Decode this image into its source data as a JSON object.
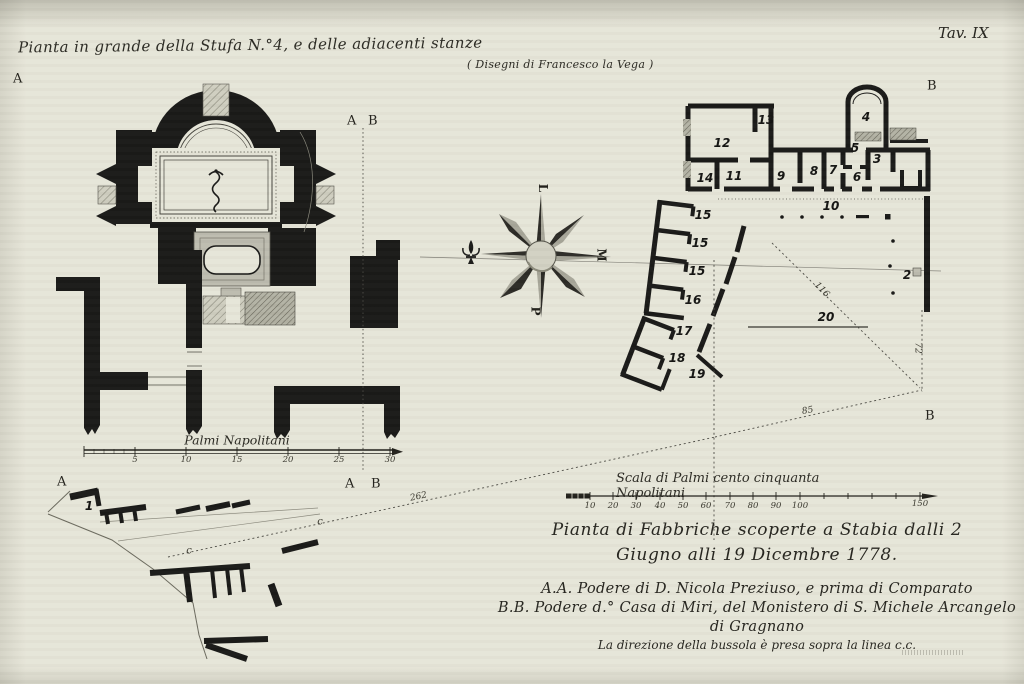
{
  "plate": {
    "number": "Tav. IX"
  },
  "titles": {
    "left_plan": "Pianta in grande della Stufa N.°4, e delle adiacenti stanze",
    "credit": "( Disegni di Francesco la Vega )"
  },
  "captions": {
    "line1": "Pianta di Fabbriche scoperte a Stabia dalli 2",
    "line2": "Giugno alli 19 Dicembre 1778.",
    "line3": "A.A. Podere di D. Nicola Preziuso, e prima di Comparato",
    "line4": "B.B. Podere d.° Casa di Miri, del Monistero di S. Michele Arcangelo",
    "line5": "di Gragnano",
    "line6": "La direzione della bussola è presa sopra la linea c.c."
  },
  "scales": {
    "left": {
      "label": "Palmi Napolitani",
      "ticks": [
        "5",
        "10",
        "15",
        "20",
        "25",
        "30"
      ]
    },
    "right": {
      "label": "Scala di Palmi cento cinquanta Napolitani",
      "ticks": [
        "10",
        "20",
        "30",
        "40",
        "50",
        "60",
        "70",
        "80",
        "90",
        "100",
        "150"
      ]
    }
  },
  "compass": {
    "east": "L",
    "south": "M",
    "west": "P"
  },
  "section_labels": {
    "a_top": "A",
    "ab_top_a": "A",
    "ab_top_b": "B",
    "ab_bottom_a": "A",
    "ab_bottom_b": "B",
    "b_top_right": "B",
    "b_bottom_right": "B",
    "a_fragment": "A"
  },
  "room_labels": {
    "r1": "1",
    "r2": "2",
    "r3": "3",
    "r4": "4",
    "r5": "5",
    "r6": "6",
    "r7": "7",
    "r8": "8",
    "r9": "9",
    "r10": "10",
    "r11": "11",
    "r12": "12",
    "r13": "13",
    "r14": "14",
    "r15a": "15",
    "r15b": "15",
    "r15c": "15",
    "r16": "16",
    "r17": "17",
    "r18": "18",
    "r19": "19",
    "r20": "20"
  },
  "measurements": {
    "m262": "262",
    "m85": "85",
    "m116": "116",
    "m72": "72",
    "c_left": "c",
    "c_right": "c"
  },
  "colors": {
    "paper": "#e6e5d8",
    "ink": "#1a1a18"
  }
}
